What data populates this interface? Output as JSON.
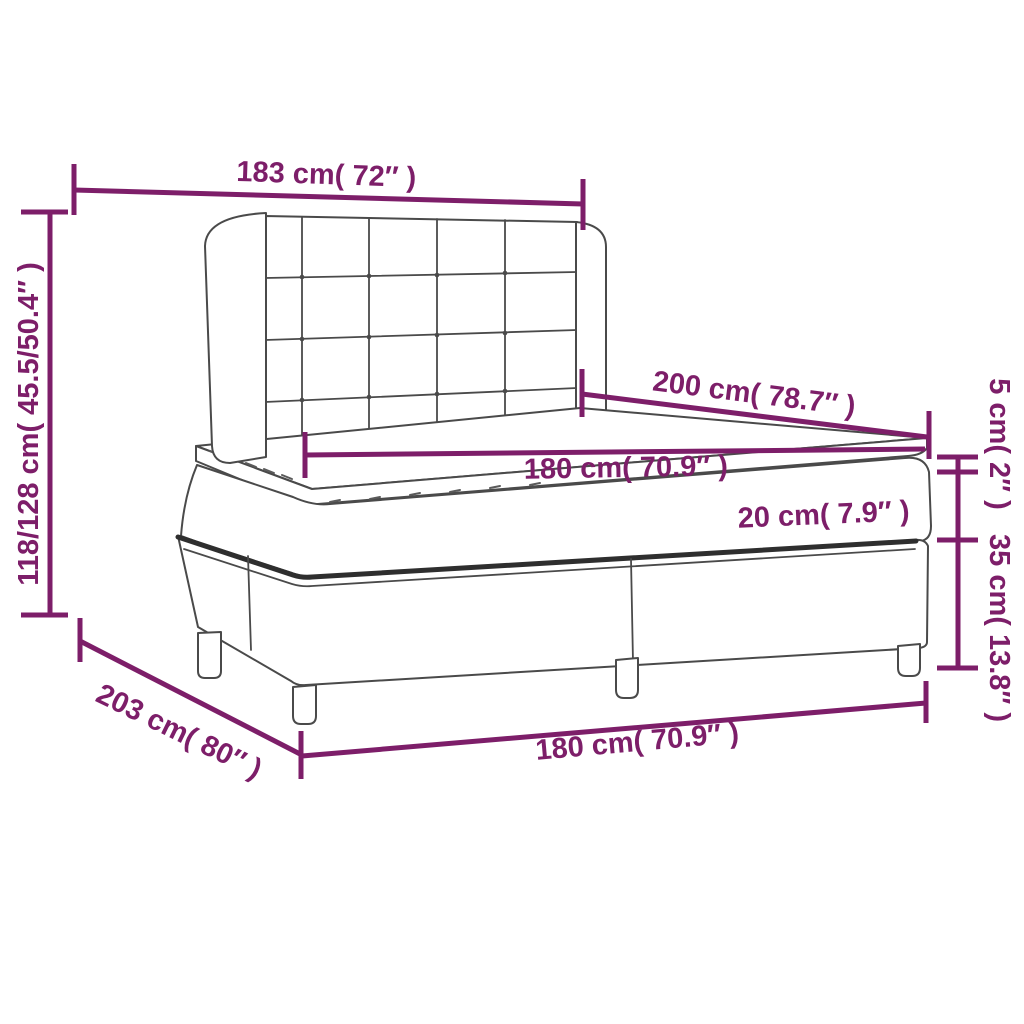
{
  "diagram": {
    "type": "product-dimension-diagram",
    "subject": "box spring bed with tufted wing headboard",
    "background": "#FFFFFF",
    "accent_color": "#7D1E69",
    "line_color": "#4A4A4A",
    "dimensions": {
      "headboard_width": "183 cm( 72″ )",
      "headboard_height": "118/128 cm( 45.5/50.4″ )",
      "mattress_length": "200 cm( 78.7″ )",
      "mattress_width": "180 cm( 70.9″ )",
      "mattress_thickness": "20 cm( 7.9″ )",
      "topper_thickness": "5 cm( 2″ )",
      "base_height": "35 cm( 13.8″ )",
      "total_length": "203 cm( 80″ )",
      "base_width": "180 cm( 70.9″ )"
    }
  }
}
